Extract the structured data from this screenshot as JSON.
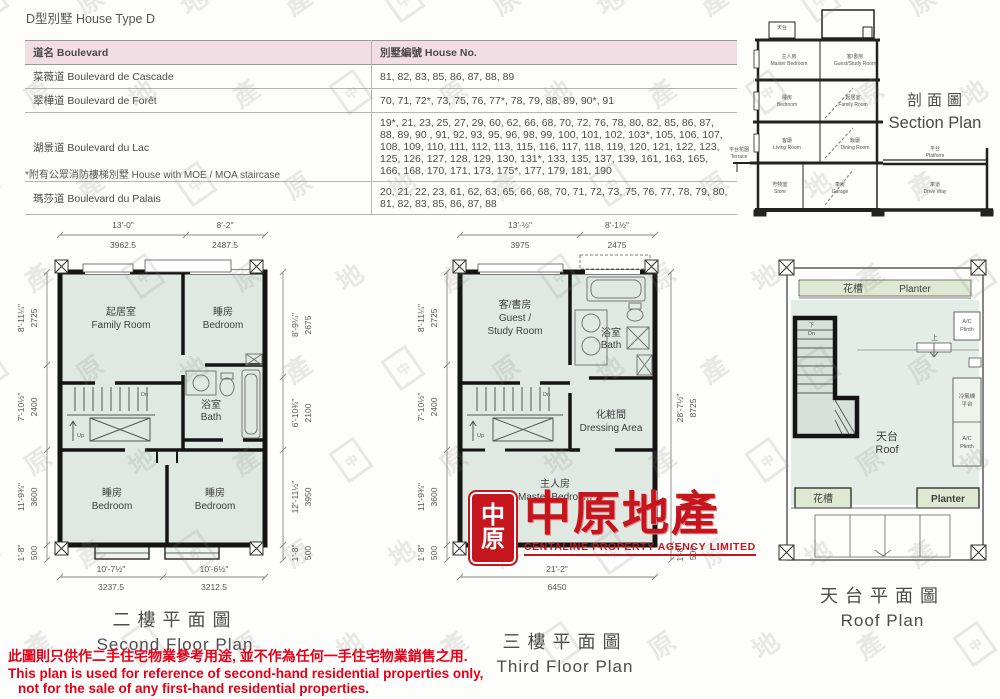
{
  "page": {
    "title": "D型別墅 House Type D",
    "footnote": "*附有公眾消防樓梯別墅 House with MOE / MOA staircase",
    "disclaimer": {
      "zh": "此圖則只供作二手住宅物業參考用途, 並不作為任何一手住宅物業銷售之用.",
      "en1": "This plan is used for reference of second-hand residential properties only,",
      "en2": "not for the sale of any first-hand residential properties."
    },
    "watermark_chars": "中原地產"
  },
  "table": {
    "col_boulevard": "道名 Boulevard",
    "col_house_no": "別墅編號 House No.",
    "rows": [
      {
        "boulevard": "菜薇道 Boulevard de Cascade",
        "houses": "81, 82, 83, 85, 86, 87, 88, 89"
      },
      {
        "boulevard": "翠樺道 Boulevard de Forêt",
        "houses": "70, 71, 72*, 73, 75, 76, 77*, 78, 79, 88, 89, 90*, 91"
      },
      {
        "boulevard": "湖景道 Boulevard du Lac",
        "houses": "19*, 21, 23, 25, 27, 29, 60, 62, 66, 68, 70, 72, 76, 78, 80, 82, 85, 86, 87, 88, 89, 90 , 91, 92, 93, 95, 96, 98, 99, 100, 101, 102, 103*, 105, 106, 107, 108, 109, 110, 111, 112, 113, 115, 116, 117, 118, 119, 120, 121, 122, 123, 125, 126, 127, 128, 129, 130, 131*, 133, 135, 137, 139, 161, 163, 165, 166, 168, 170, 171, 173, 175*, 177, 179, 181, 190"
      },
      {
        "boulevard": "瑪莎道 Boulevard du Palais",
        "houses": "20, 21, 22, 23, 61, 62, 63, 65, 66, 68, 70, 71, 72, 73, 75, 76, 77, 78, 79, 80, 81, 82, 83, 85, 86, 87, 88"
      }
    ]
  },
  "section": {
    "title_zh": "剖面圖",
    "title_en": "Section Plan",
    "rooms": {
      "roof": {
        "zh": "天台",
        "en": "Roof"
      },
      "master": {
        "zh": "主人房",
        "en": "Master Bedroom"
      },
      "guest": {
        "zh": "客/書房",
        "en": "Guest/Study Room"
      },
      "bedroom": {
        "zh": "睡房",
        "en": "Bedroom"
      },
      "family": {
        "zh": "起居室",
        "en": "Family Room"
      },
      "living": {
        "zh": "客廳",
        "en": "Living Room"
      },
      "dining": {
        "zh": "飯廳",
        "en": "Dining Room"
      },
      "terrace": {
        "zh": "平台花園",
        "en": "Terrace"
      },
      "platform": {
        "zh": "平台",
        "en": "Platform"
      },
      "store": {
        "zh": "貯物室",
        "en": "Store"
      },
      "garage": {
        "zh": "車房",
        "en": "Garage"
      },
      "driveway": {
        "zh": "車道",
        "en": "Drive Way"
      }
    }
  },
  "second_floor": {
    "title_zh": "二樓平面圖",
    "title_en": "Second Floor Plan",
    "rooms": {
      "family": {
        "zh": "起居室",
        "en": "Family Room"
      },
      "bedroom1": {
        "zh": "睡房",
        "en": "Bedroom"
      },
      "bath": {
        "zh": "浴室",
        "en": "Bath"
      },
      "bedroom2": {
        "zh": "睡房",
        "en": "Bedroom"
      },
      "bedroom3": {
        "zh": "睡房",
        "en": "Bedroom"
      }
    },
    "stairs": {
      "dn": "Dn",
      "up": "Up"
    },
    "dims": {
      "top": [
        {
          "ft": "13'-0\"",
          "mm": "3962.5"
        },
        {
          "ft": "8'-2\"",
          "mm": "2487.5"
        }
      ],
      "left": [
        {
          "ft": "8'-11¼\"",
          "mm": "2725"
        },
        {
          "ft": "7'-10½\"",
          "mm": "2400"
        },
        {
          "ft": "11'-9¾\"",
          "mm": "3600"
        },
        {
          "ft": "1'-8\"",
          "mm": "500"
        }
      ],
      "right": [
        {
          "ft": "8'-9¼\"",
          "mm": "2675"
        },
        {
          "ft": "6'-10¾\"",
          "mm": "2100"
        },
        {
          "ft": "12'-11½\"",
          "mm": "3950"
        },
        {
          "ft": "1'-8\"",
          "mm": "500"
        }
      ],
      "bottom": [
        {
          "ft": "10'-7½\"",
          "mm": "3237.5"
        },
        {
          "ft": "10'-6½\"",
          "mm": "3212.5"
        }
      ]
    }
  },
  "third_floor": {
    "title_zh": "三樓平面圖",
    "title_en": "Third Floor Plan",
    "rooms": {
      "guest": {
        "zh": "客/書房",
        "en1": "Guest /",
        "en2": "Study Room"
      },
      "bath": {
        "zh": "浴室",
        "en": "Bath"
      },
      "dressing": {
        "zh": "化粧間",
        "en": "Dressing Area"
      },
      "master": {
        "zh": "主人房",
        "en": "Master Bedroom"
      }
    },
    "stairs": {
      "dn": "Dn",
      "up": "Up"
    },
    "dims": {
      "top": [
        {
          "ft": "13'-½\"",
          "mm": "3975"
        },
        {
          "ft": "8'-1½\"",
          "mm": "2475"
        }
      ],
      "left": [
        {
          "ft": "8'-11¼\"",
          "mm": "2725"
        },
        {
          "ft": "7'-10½\"",
          "mm": "2400"
        },
        {
          "ft": "11'-9¾\"",
          "mm": "3600"
        },
        {
          "ft": "1'-8\"",
          "mm": "500"
        }
      ],
      "right": [
        {
          "ft": "28'-7½\"",
          "mm": "8725"
        },
        {
          "ft": "1'-8\"",
          "mm": "500"
        }
      ],
      "bottom": [
        {
          "ft": "21'-2\"",
          "mm": "6450"
        }
      ]
    }
  },
  "roof": {
    "title_zh": "天台平面圖",
    "title_en": "Roof Plan",
    "labels": {
      "planter_zh": "花槽",
      "planter_en": "Planter",
      "roof_zh": "天台",
      "roof_en": "Roof",
      "ac": "A/C",
      "plinth": "Plinth",
      "ac_platform_zh1": "冷氣機",
      "ac_platform_zh2": "平台",
      "up": "上",
      "dn_zh": "下",
      "dn_en": "Dn",
      "planter_bl": "花槽",
      "planter_br": "Planter"
    }
  },
  "logo": {
    "seal_char1": "中",
    "seal_char2": "原",
    "name": "中原地產",
    "subtitle": "CENTALINE PROPERTY AGENCY LIMITED"
  }
}
